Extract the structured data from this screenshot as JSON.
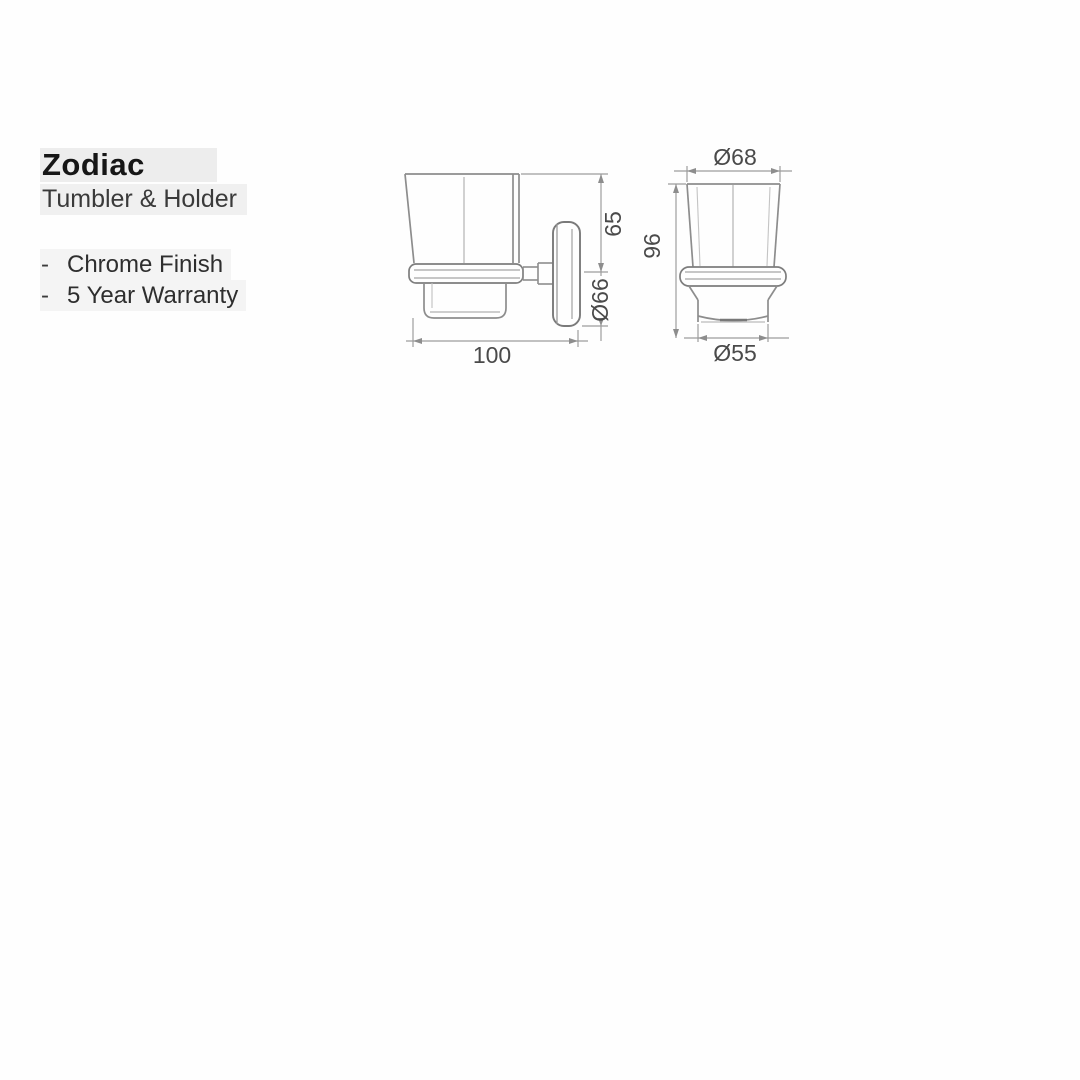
{
  "product": {
    "name": "Zodiac",
    "subtitle": "Tumbler & Holder",
    "features": [
      {
        "bullet": "-",
        "text": "Chrome Finish"
      },
      {
        "bullet": "-",
        "text": "5 Year Warranty"
      }
    ]
  },
  "drawings": {
    "side_view": {
      "dims": {
        "mount_height": "65",
        "plate_diameter": "Ø66",
        "depth": "100"
      }
    },
    "front_view": {
      "dims": {
        "top_diameter": "Ø68",
        "overall_height": "96",
        "base_diameter": "Ø55"
      }
    }
  },
  "colors": {
    "line": "#8d8d8d",
    "line_light": "#c0c0c0",
    "dim_line": "#9d9d9d",
    "dim_text": "#4a4a4a",
    "title_text": "#161616",
    "body_text": "#2e2e2e",
    "highlight": "#ededed"
  }
}
